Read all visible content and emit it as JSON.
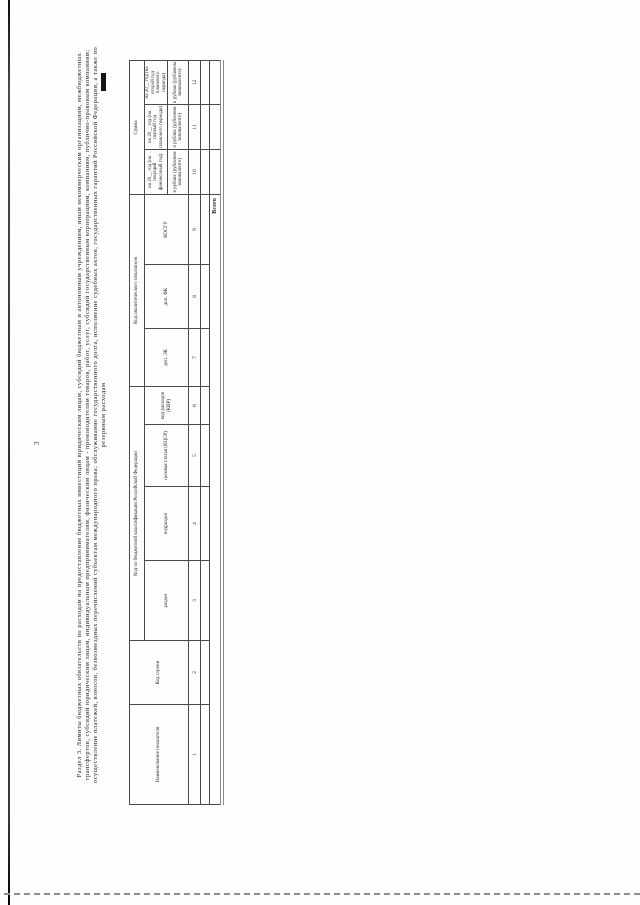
{
  "page": {
    "number": "3"
  },
  "colors": {
    "ink": "#2b2b2b",
    "table_border": "#4a4a4a",
    "thick_bottom_rule": "#8a8a8a",
    "redaction": "#151515",
    "scan_edge": "#1c1c1c"
  },
  "section": {
    "title_lines": [
      "Раздел 3. Лимиты бюджетных обязательств по расходам на предоставление бюджетных инвестиций юридическим лицам, субсидий бюджетным и автономным учреждениям, иным некоммерческим организациям, межбюджетных",
      "трансфертов, субсидий юридическим лицам, индивидуальным предпринимателям, физическим лицам - производителям товаров, работ, услуг, субсидий государственным корпорациям, компаниям, публично-правовым компаниям;",
      "осуществление платежей, взносов, безвозмездных перечислений субъектам международного права; обслуживание государственного долга, исполнение судебных актов, государственных гарантий Российской Федерации, а также по",
      "резервным расходам"
    ]
  },
  "table": {
    "header": {
      "name_col": "Наименование показателя",
      "line_code_col": "Код строки",
      "bk_group": "Код по бюджетной классификации Российской Федерации",
      "bk_cols": [
        "раздел",
        "подраздел",
        "целевая статья (КЦСР)",
        "вид расходов (КВР)"
      ],
      "analytic_group": "Код аналитического показателя",
      "analytic_cols": [
        "доп. ЭК",
        "доп. ФК",
        "КОСГУ"
      ],
      "sum_group": "Сумма",
      "sum_cols": [
        {
          "year": "на 20__ год (на текущий финансовый год)",
          "unit": "в рублях (рублевом эквиваленте)"
        },
        {
          "year": "на 20__ год (на первый год планового периода)",
          "unit": "в рублях (рублевом эквиваленте)"
        },
        {
          "year": "на 20__ год (на второй год планового периода)",
          "unit": "в рублях (рублевом эквиваленте)"
        }
      ],
      "numbers": [
        "1",
        "2",
        "3",
        "4",
        "5",
        "6",
        "7",
        "8",
        "9",
        "10",
        "11",
        "12"
      ]
    },
    "rows": [
      {
        "name": "",
        "values": [
          "",
          "",
          ""
        ]
      }
    ],
    "total_row_label": "Всего"
  }
}
